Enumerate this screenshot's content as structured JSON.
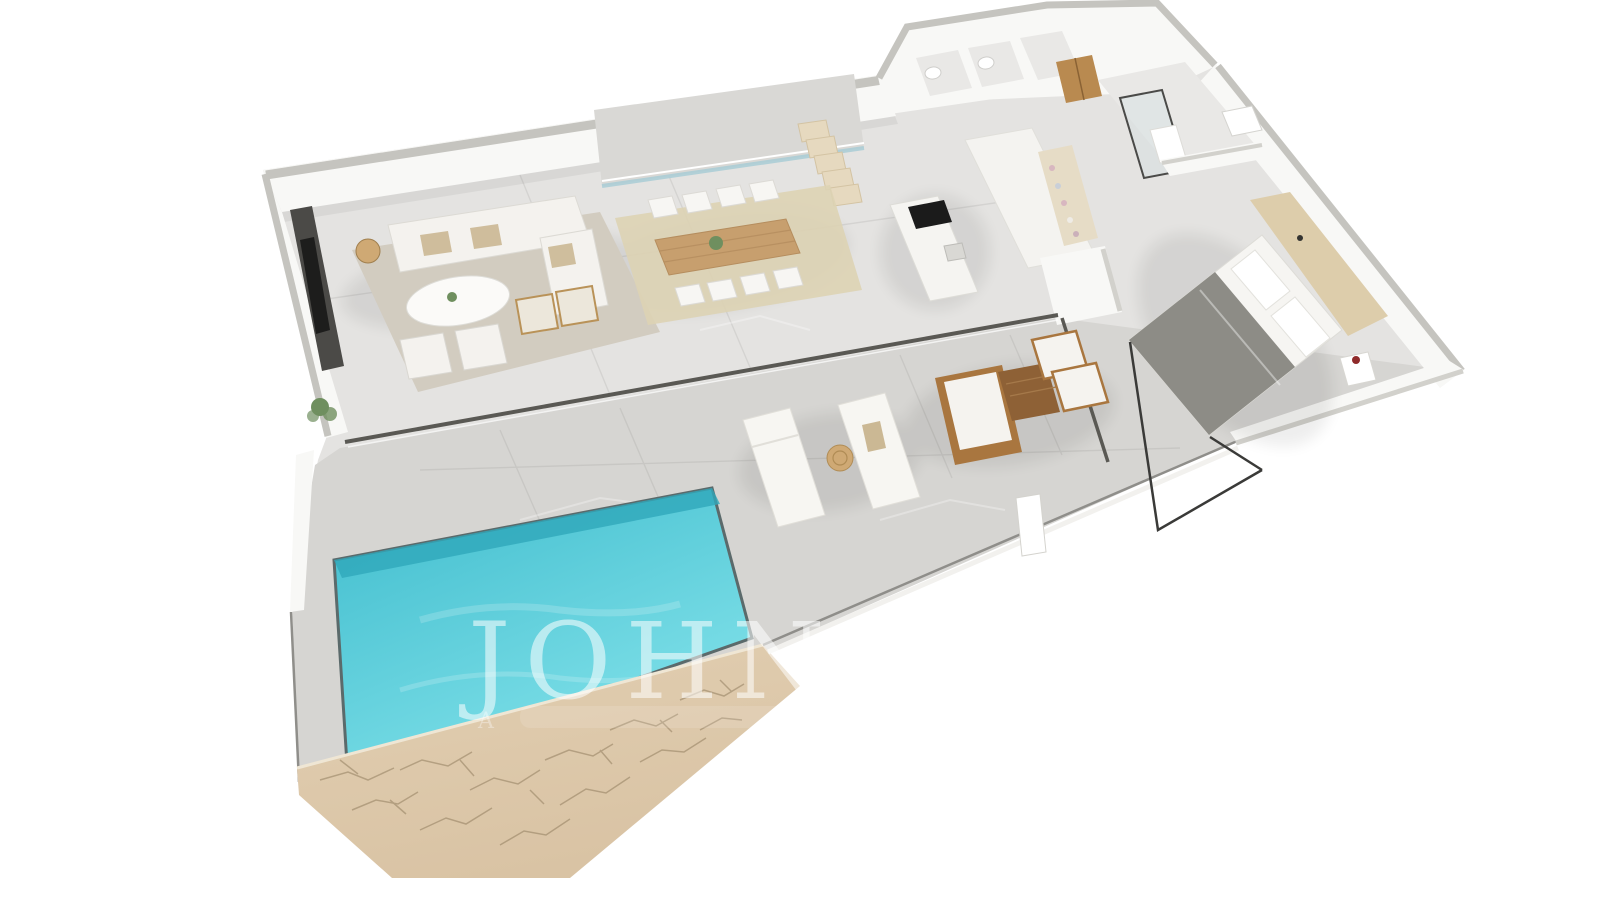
{
  "watermark": {
    "line1": "JOHN T",
    "line2": "A",
    "color": "#ffffff",
    "opacity_main": "0.55",
    "opacity_sub": "0.35"
  },
  "scene": {
    "type": "3d-floor-plan-render",
    "description": "Aerial 3D cutaway floor plan of a villa level with living room, dining area, kitchen, bedroom, bathrooms, terrace and swimming pool",
    "rooms": [
      {
        "name": "living-room",
        "furniture": [
          "sectional-sofa",
          "coffee-table",
          "armchair",
          "armchair",
          "accent-chair",
          "accent-chair",
          "round-side-table",
          "tv-wall",
          "area-rug",
          "floor-plant"
        ]
      },
      {
        "name": "dining-area",
        "furniture": [
          "wood-dining-table",
          "dining-chair-x8",
          "area-rug",
          "plant-centerpiece"
        ]
      },
      {
        "name": "staircase",
        "features": [
          "glass-balustrade",
          "wood-steps"
        ]
      },
      {
        "name": "kitchen",
        "furniture": [
          "island-with-cooktop",
          "sink",
          "counter-block",
          "pantry-shelves",
          "partition-wall"
        ]
      },
      {
        "name": "wc-1",
        "furniture": [
          "toilet"
        ]
      },
      {
        "name": "wc-2",
        "furniture": [
          "toilet"
        ]
      },
      {
        "name": "entry-hall",
        "features": [
          "wood-door"
        ]
      },
      {
        "name": "bathroom",
        "furniture": [
          "glass-shower",
          "washbasin"
        ]
      },
      {
        "name": "bedroom",
        "furniture": [
          "double-bed",
          "canopy-frame",
          "headboard-panel",
          "nightstand",
          "red-lamp",
          "wardrobe"
        ]
      },
      {
        "name": "terrace",
        "furniture": [
          "sun-lounger",
          "sun-lounger",
          "rattan-side-table",
          "outdoor-sofa",
          "outdoor-coffee-table",
          "outdoor-armchair",
          "outdoor-armchair",
          "pillar"
        ]
      },
      {
        "name": "pool-deck",
        "features": [
          "swimming-pool",
          "stone-retaining-wall",
          "parapet"
        ]
      }
    ]
  },
  "colors": {
    "bg": "#ffffff",
    "floor_in": "#e4e3e1",
    "floor_out": "#d6d5d2",
    "floor_annex": "#e9e8e6",
    "wall": "#f8f8f6",
    "wall_cap": "#c5c4bf",
    "wall_cap_light": "#d2d1cc",
    "track": "#5a5954",
    "tv": "#4b4a47",
    "tv_screen": "#1d1d1c",
    "rug_living": "#d2ccc0",
    "rug_dining": "#ddd3b4",
    "sofa": "#f4f2ee",
    "cushion": "#cbb894",
    "wood": "#c79f6e",
    "wood_dark": "#8e6136",
    "wood_mid": "#a9763f",
    "wood_door": "#b98a50",
    "rattan": "#cfa974",
    "cream": "#e6dcc6",
    "headboard": "#ddcdab",
    "duvet": "#8d8c86",
    "frame_dark": "#3a3a38",
    "pool_deep": "#2fa8ba",
    "pool_main": "#3fbccd",
    "pool_light": "#82e2ea",
    "stone": "#d9c3a4",
    "stone_line": "#937f60",
    "glass": "#aacdd6",
    "plant": "#6f8f5f",
    "lamp_red": "#8f2b2b",
    "shadow": "#000000"
  }
}
